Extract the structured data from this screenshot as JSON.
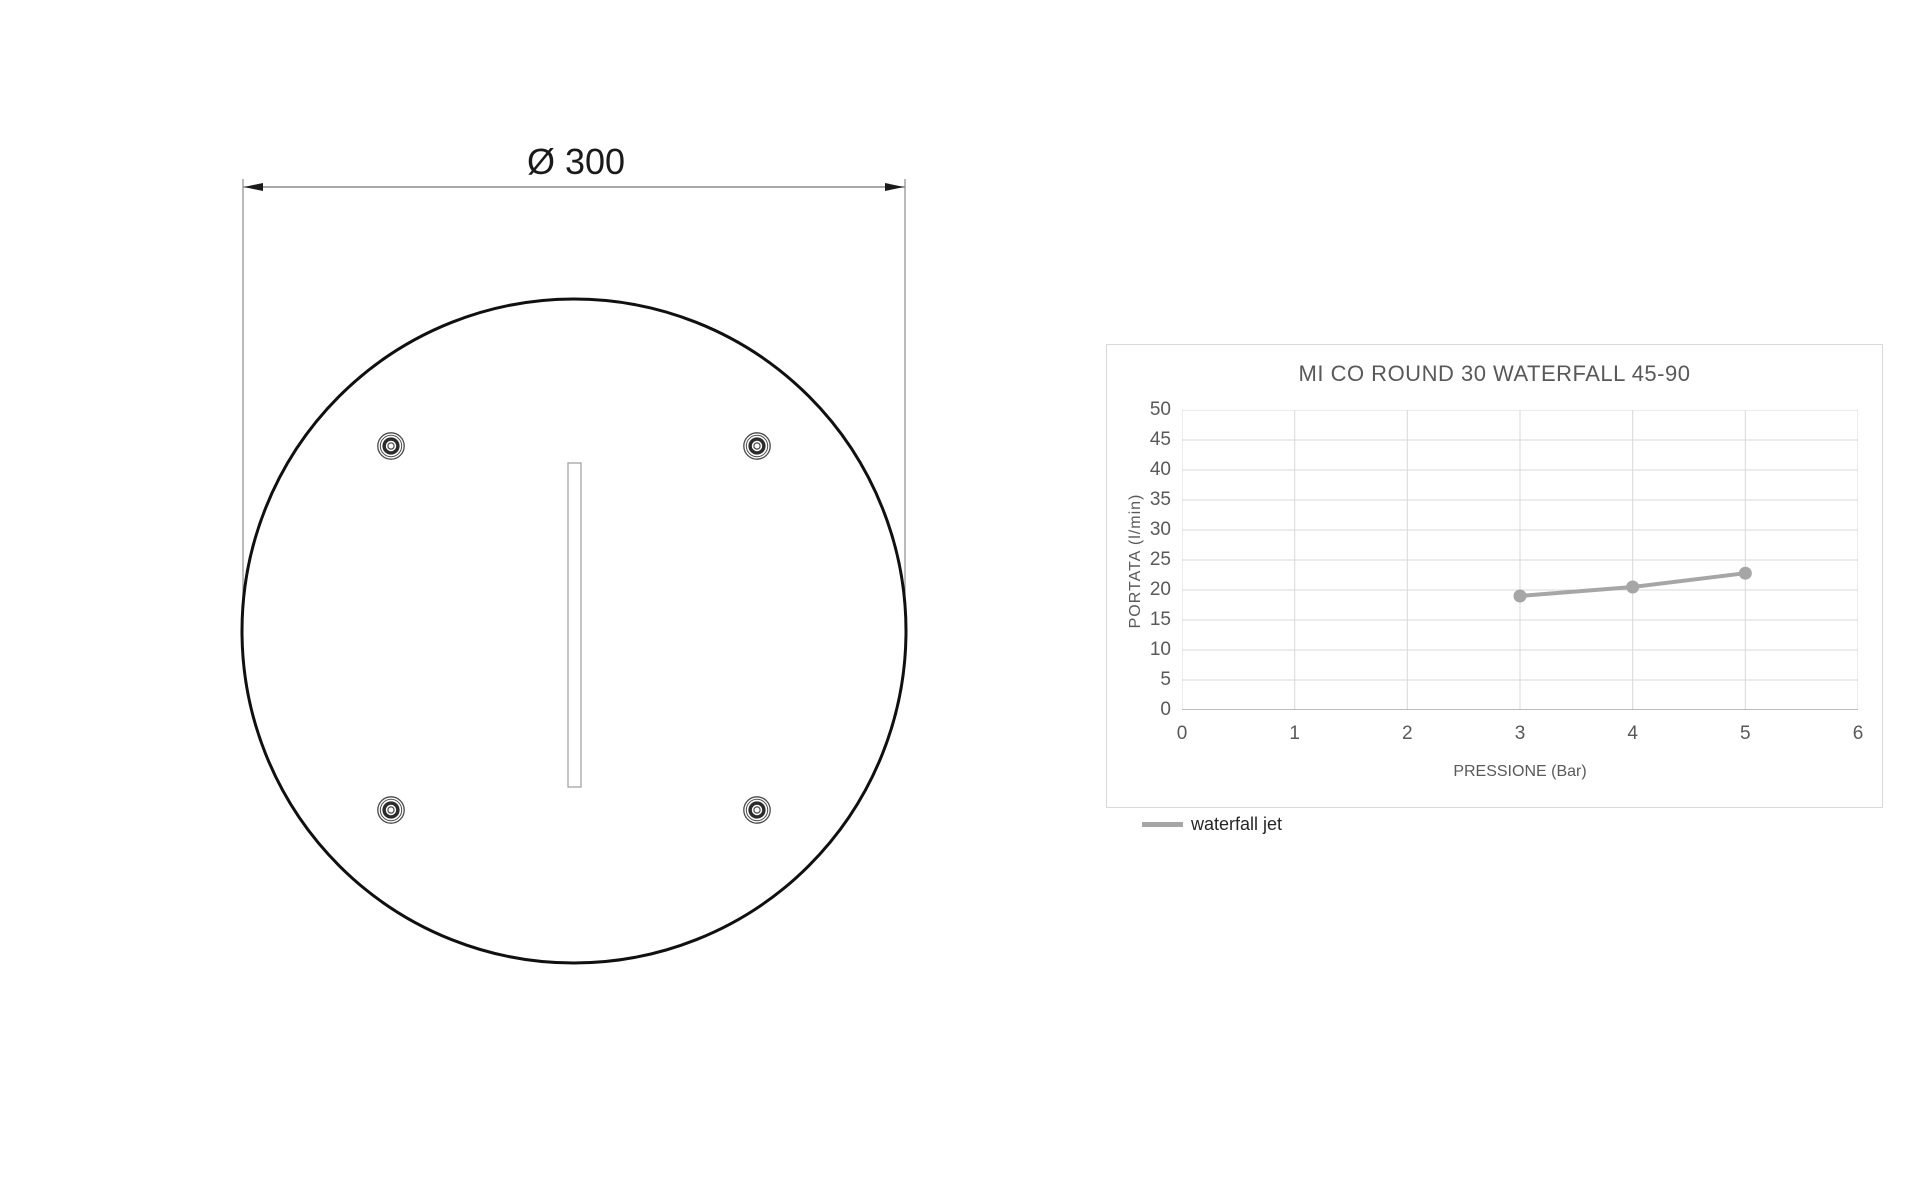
{
  "drawing": {
    "dimension_label": "Ø 300",
    "diameter_value": 300,
    "fastener_count": 4,
    "line_color": "#101010",
    "dimension_color": "#8c8c8c"
  },
  "chart_data": {
    "type": "line",
    "title": "MI CO ROUND 30 WATERFALL 45-90",
    "xlabel": "PRESSIONE (Bar)",
    "ylabel": "PORTATA (l/min)",
    "xlim": [
      0,
      6
    ],
    "ylim": [
      0,
      50
    ],
    "x_ticks": [
      "0",
      "1",
      "2",
      "3",
      "4",
      "5",
      "6"
    ],
    "y_ticks": [
      "0",
      "5",
      "10",
      "15",
      "20",
      "25",
      "30",
      "35",
      "40",
      "45",
      "50"
    ],
    "grid": true,
    "legend_position": "bottom-left",
    "series": [
      {
        "name": "waterfall jet",
        "x": [
          3,
          4,
          5
        ],
        "y": [
          19,
          20.5,
          22.8
        ],
        "color": "#a6a6a6"
      }
    ]
  },
  "chart_style": {
    "grid_color": "#d9d9d9",
    "axis_color": "#a6a6a6",
    "text_color": "#595959",
    "title_color": "#595959",
    "legend_text_color": "#262626"
  }
}
